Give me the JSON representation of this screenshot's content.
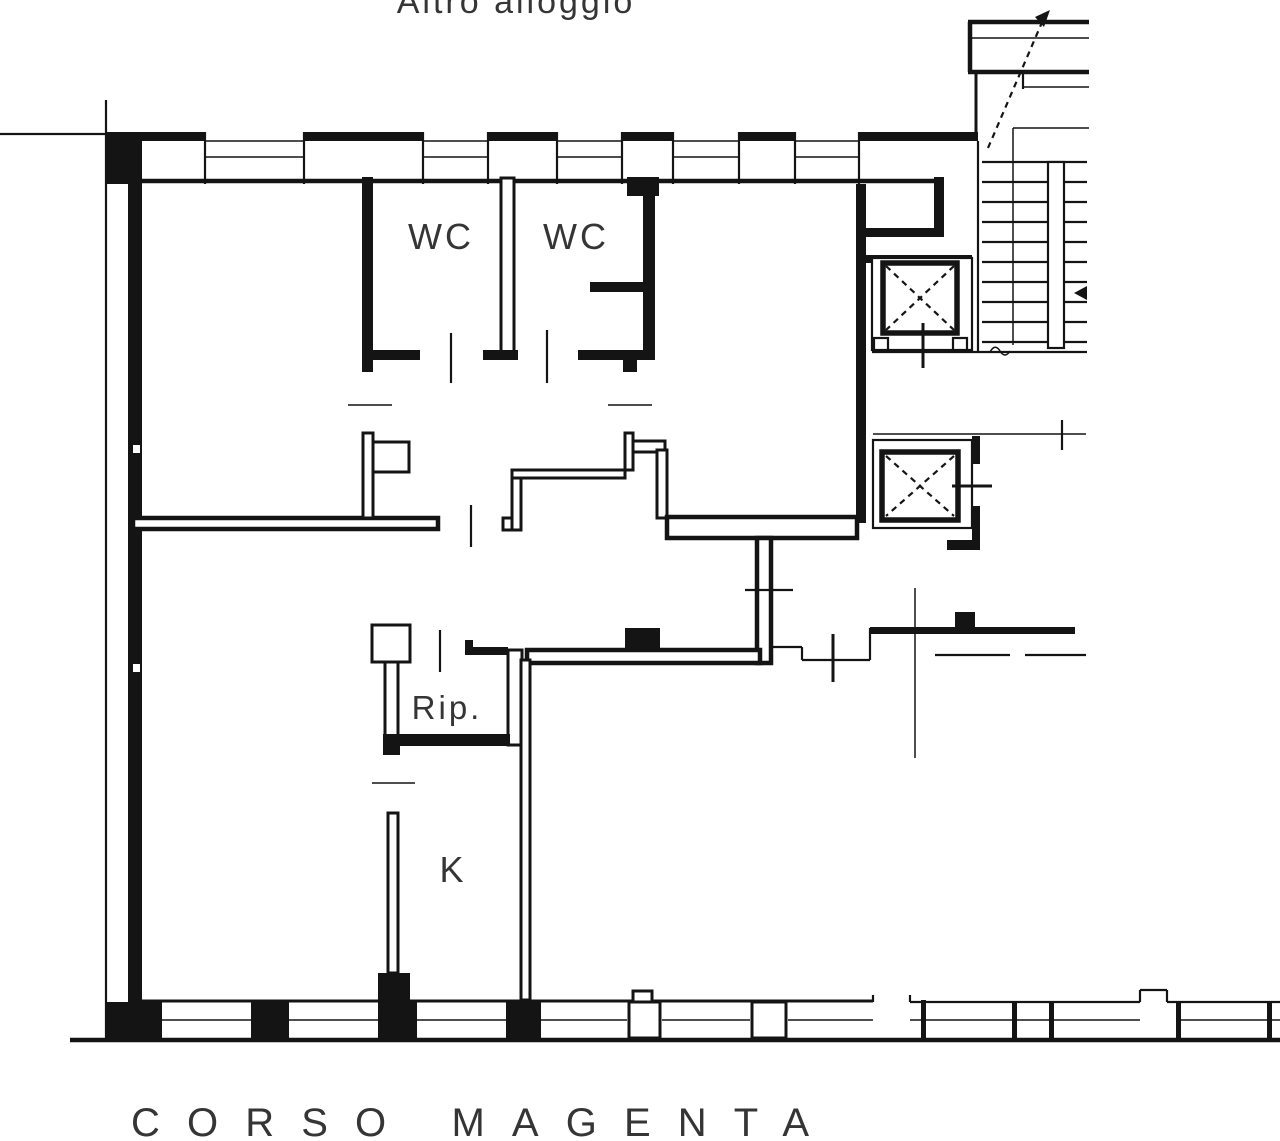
{
  "colors": {
    "line": "#141414",
    "text": "#353535",
    "background": "#ffffff"
  },
  "labels": {
    "adjacent_unit": "Altro alloggio",
    "wc_1": "WC",
    "wc_2": "WC",
    "storage": "Rip.",
    "kitchen": "K",
    "street": "CORSO MAGENTA"
  },
  "plan": {
    "type": "architectural-floor-plan",
    "street_side": "bottom",
    "features": [
      "two WC rooms at top",
      "storage room (Rip.)",
      "kitchen (K)",
      "two elevator shafts with X marks",
      "staircase with direction arrow",
      "window openings along top and bottom exterior walls"
    ]
  }
}
